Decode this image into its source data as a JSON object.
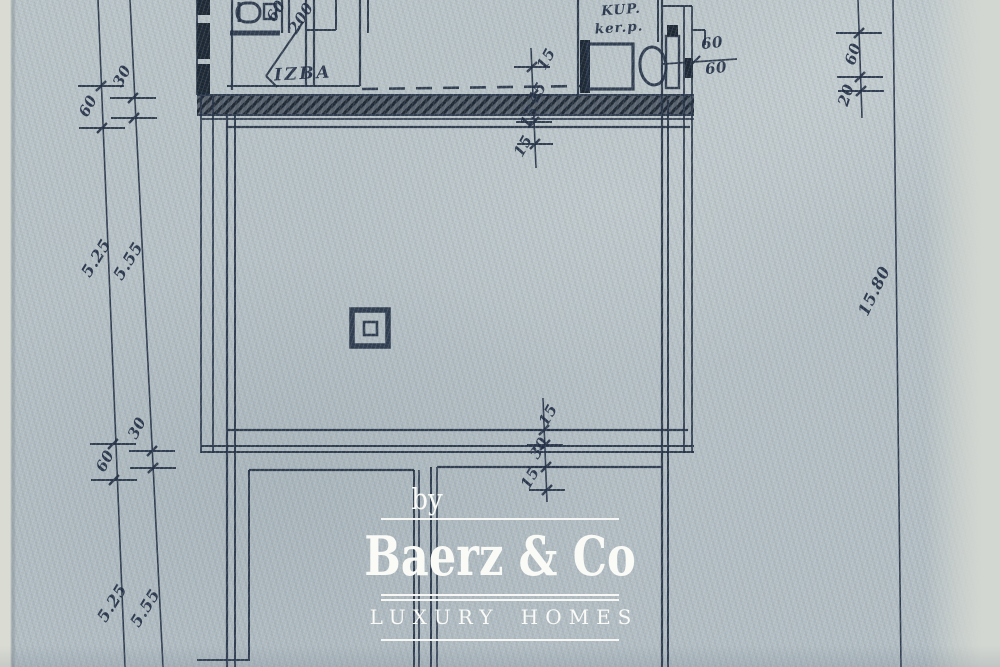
{
  "watermark": {
    "prefix": "by",
    "brand": "Baerz & Co",
    "tagline": "LUXURY HOMES"
  },
  "rooms": {
    "izba": "IZBA",
    "kup_line1": "KUP.",
    "kup_line2": "ker.p."
  },
  "dims": {
    "left_top_outer": "60",
    "left_top_inner": "30",
    "left_span_a": "5.25",
    "left_span_b": "5.55",
    "left_low_inner": "30",
    "left_low_outer": "60",
    "left_bot_a": "5.25",
    "left_bot_b": "5.55",
    "right_top_a": "60",
    "right_top_b": "20",
    "right_total": "15.80",
    "bath_a": "60",
    "bath_b": "60",
    "door_w": "60",
    "door_h": "200",
    "ct1": "15",
    "ct2": "45",
    "ct3": "15",
    "ct4": "15",
    "cb1": "15",
    "cb2": "30",
    "cb3": "15"
  },
  "colors": {
    "ink": "#233146",
    "paper": "#b8c4c9",
    "watermark_white": "#fafaf7"
  }
}
